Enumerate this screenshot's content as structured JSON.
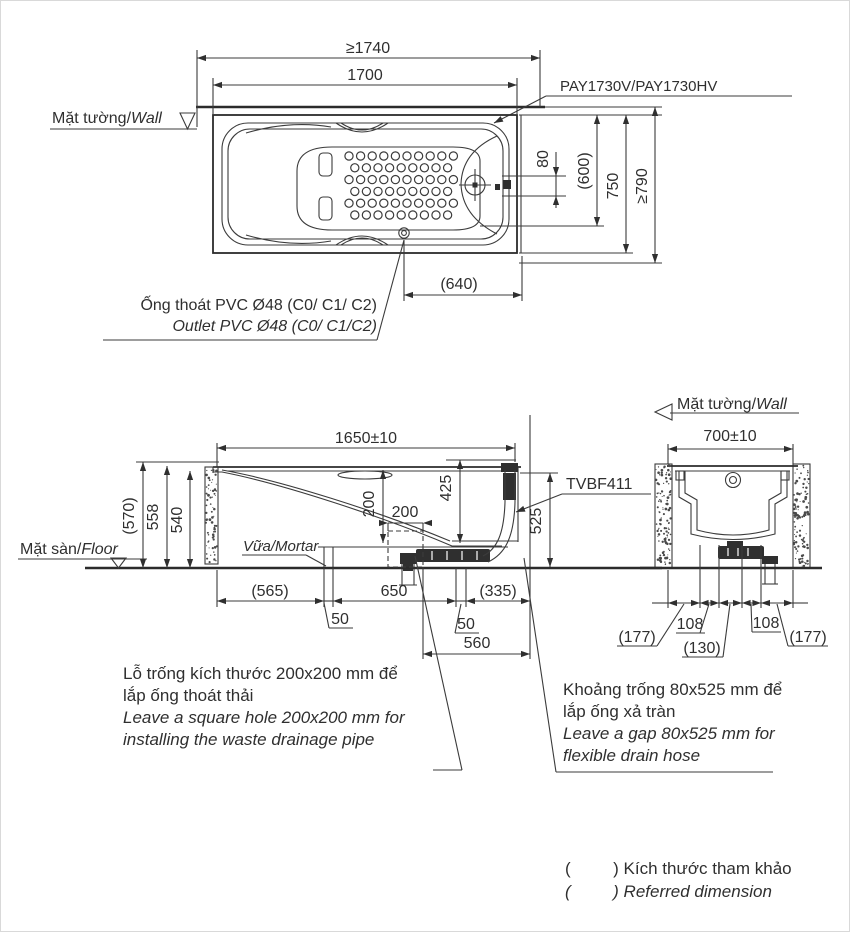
{
  "colors": {
    "ink": "#2f2f2f",
    "background": "#ffffff"
  },
  "top_view": {
    "wall_label_vi": "Mặt tường/",
    "wall_label_en": "Wall",
    "model_label": "PAY1730V/PAY1730HV",
    "dim_overall_length": "≥1740",
    "dim_length": "1700",
    "dim_offset": "80",
    "dim_inner_width": "(600)",
    "dim_width": "750",
    "dim_overall_width": "≥790",
    "dim_drain": "(640)",
    "outlet_note_vi": "Ống thoát PVC Ø48 (C0/ C1/ C2)",
    "outlet_note_en": "Outlet PVC Ø48 (C0/ C1/C2)"
  },
  "side_view": {
    "dim_length": "1650±10",
    "dim_h_total": "(570)",
    "dim_h_rim": "558",
    "dim_h_inner": "540",
    "floor_label_vi": "Mặt sàn/",
    "floor_label_en": "Floor",
    "mortar_label": "Vữa/Mortar",
    "part_label": "TVBF411",
    "dim_depth": "200",
    "dim_hole": "200",
    "dim_425": "425",
    "dim_525": "525",
    "dim_565": "(565)",
    "dim_650": "650",
    "dim_50_left": "50",
    "dim_50_right": "50",
    "dim_335": "(335)",
    "dim_560": "560"
  },
  "section_view": {
    "wall_label_vi": "Mặt tường/",
    "wall_label_en": "Wall",
    "dim_width": "700±10",
    "dim_177_left": "(177)",
    "dim_108_left": "108",
    "dim_130": "(130)",
    "dim_108_right": "108",
    "dim_177_right": "(177)"
  },
  "notes": {
    "hole_note_vi_line1": "Lỗ trống kích thước 200x200 mm để",
    "hole_note_vi_line2": "lắp ống thoát thải",
    "hole_note_en_line1": "Leave a square hole  200x200 mm for",
    "hole_note_en_line2": "installing the waste drainage pipe",
    "gap_note_vi_line1": "Khoảng trống 80x525 mm để",
    "gap_note_vi_line2": "lắp ống xả tràn",
    "gap_note_en_line1": "Leave a gap 80x525 mm for",
    "gap_note_en_line2": "flexible drain hose",
    "legend_vi": "(         ) Kích thước tham khảo",
    "legend_en": "(         ) Referred dimension"
  }
}
